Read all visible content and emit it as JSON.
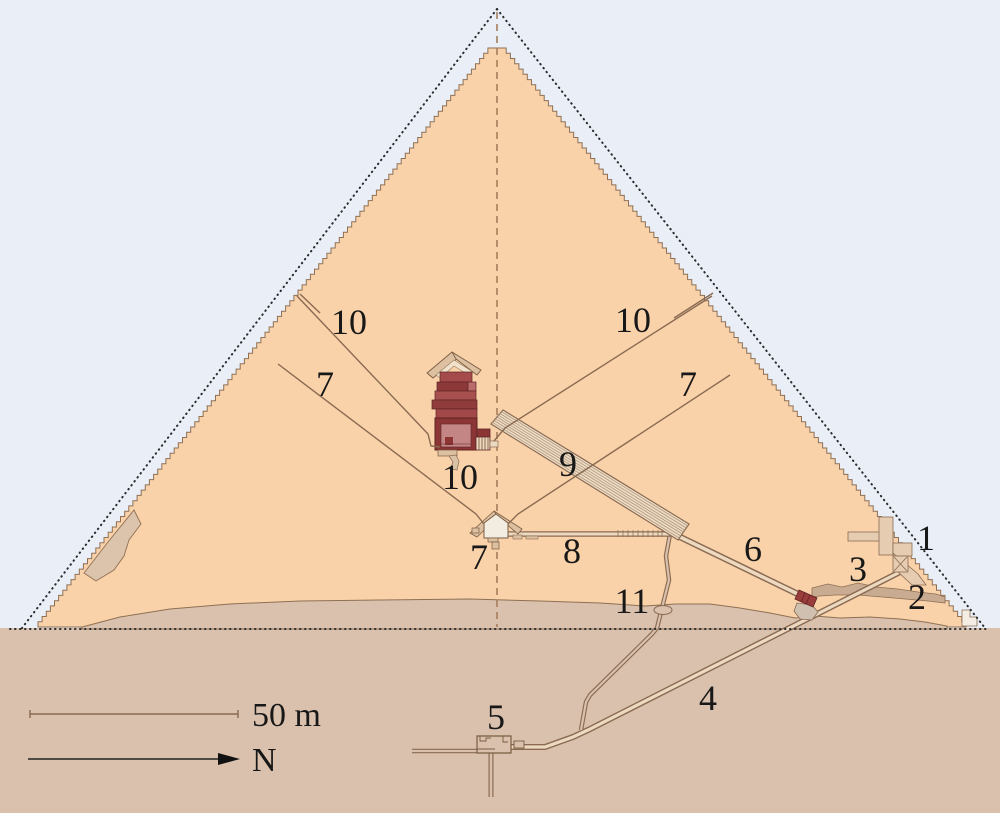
{
  "diagram": {
    "labels": {
      "1": "1",
      "2": "2",
      "3": "3",
      "4": "4",
      "5": "5",
      "6": "6",
      "7": "7",
      "8": "8",
      "9": "9",
      "10": "10",
      "11": "11"
    },
    "scale_bar": {
      "label": "50 m"
    },
    "compass": {
      "label": "N"
    }
  },
  "colors": {
    "sky": "#e9eef7",
    "pyramid_masonry": "#f9d2a9",
    "bedrock_ground": "#d9c1ad",
    "chamber_red": "#8c3535",
    "structure_tan": "#dcc0a0",
    "gallery_fill": "#ecdcc6",
    "line_brown": "#8a6a52"
  }
}
